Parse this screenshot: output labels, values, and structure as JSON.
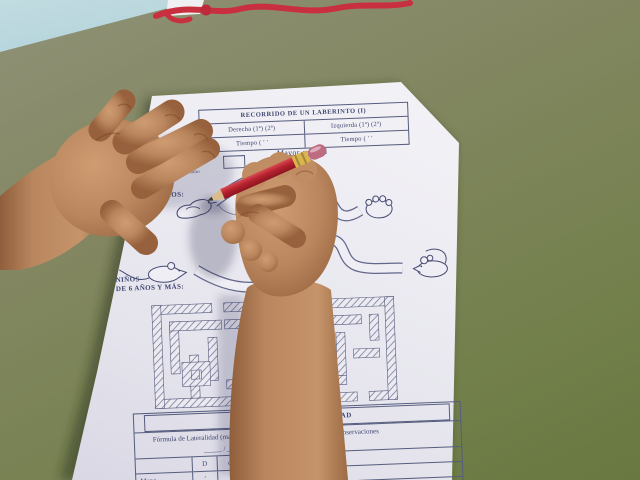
{
  "photo": {
    "subject": "child tracing a maze worksheet with a red pencil",
    "objects": [
      "left-hand",
      "right-hand",
      "red-pencil",
      "red-cord",
      "blue-paper-corner",
      "maze-worksheet",
      "green-table"
    ],
    "colors": {
      "table_green": "#7b8159",
      "paper_white": "#efeef4",
      "blue_paper": "#a9ced7",
      "cord_red": "#c9303f",
      "pencil_red": "#b6222f",
      "pencil_ferrule": "#d9b54e",
      "pencil_eraser": "#bc6b80",
      "skin": "#b9865e",
      "ink_blue": "#3a406a"
    }
  },
  "worksheet": {
    "header_table": {
      "title": "RECORRIDO DE UN LABERINTO (I)",
      "left_col": "Derecha  (1ª)      (2ª)",
      "right_col": "Izquierda  (1ª)      (2ª)",
      "left_time": "Tiempo  (      ′      ′",
      "right_time": "Tiempo  (      ′      ′",
      "quality_label": "Mayor calidad",
      "footnote": "(1) Señalar preferencia de mano"
    },
    "section_young": {
      "line1": "NIÑOS",
      "line2": "DE 4-5 AÑOS:"
    },
    "section_older": {
      "line1": "NIÑOS",
      "line2": "DE 6 AÑOS Y MÁS:"
    },
    "drawings": {
      "path1_start_icon": "bird-icon",
      "path1_end_icon": "paw-icon",
      "path2_start_icon": "mouse-icon",
      "path2_end_icon": "mouse-icon",
      "maze_icon": "hatched-maze"
    },
    "laterality_table": {
      "title": "GRÁFICA DE LATERALIDAD",
      "formula_label": "Fórmula de Lateralidad (mano",
      "observations_label": "Observaciones",
      "slashes": "_____ /  _____ /",
      "columns": [
        "D",
        "d"
      ],
      "row_labels": [
        "Mano",
        "Ojo"
      ],
      "mano_values": [
        "′",
        "′"
      ]
    }
  }
}
